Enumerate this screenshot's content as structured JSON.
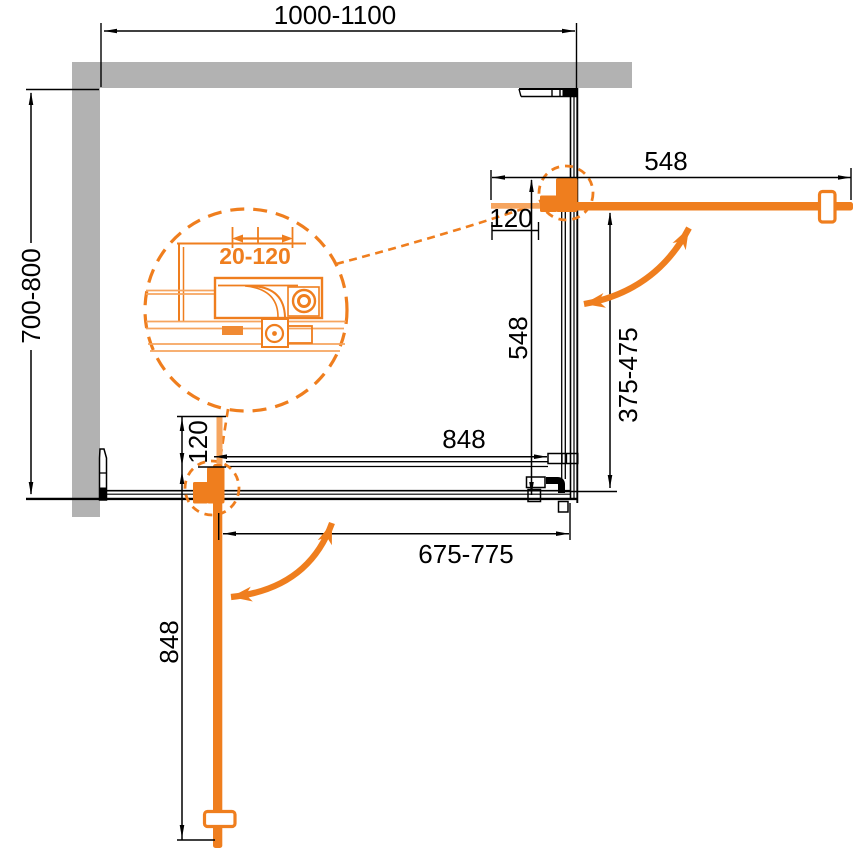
{
  "drawing": {
    "type": "shower-enclosure-plan-diagram",
    "colors": {
      "accent_orange": "#EF7E1E",
      "accent_orange_light": "#F6A55F",
      "wall_gray": "#B2B2B2",
      "line_black": "#000000",
      "background": "#FFFFFF"
    },
    "dimensions": {
      "top_width": "1000-1100",
      "left_depth": "700-800",
      "right_door_width": "548",
      "right_pivot_offset": "120",
      "right_panel_length": "548",
      "right_opening": "375-475",
      "bottom_span": "848",
      "bottom_opening": "675-775",
      "bottom_pivot_offset": "120",
      "bottom_door_length": "848",
      "detail_adjustment_range": "20-120"
    }
  }
}
